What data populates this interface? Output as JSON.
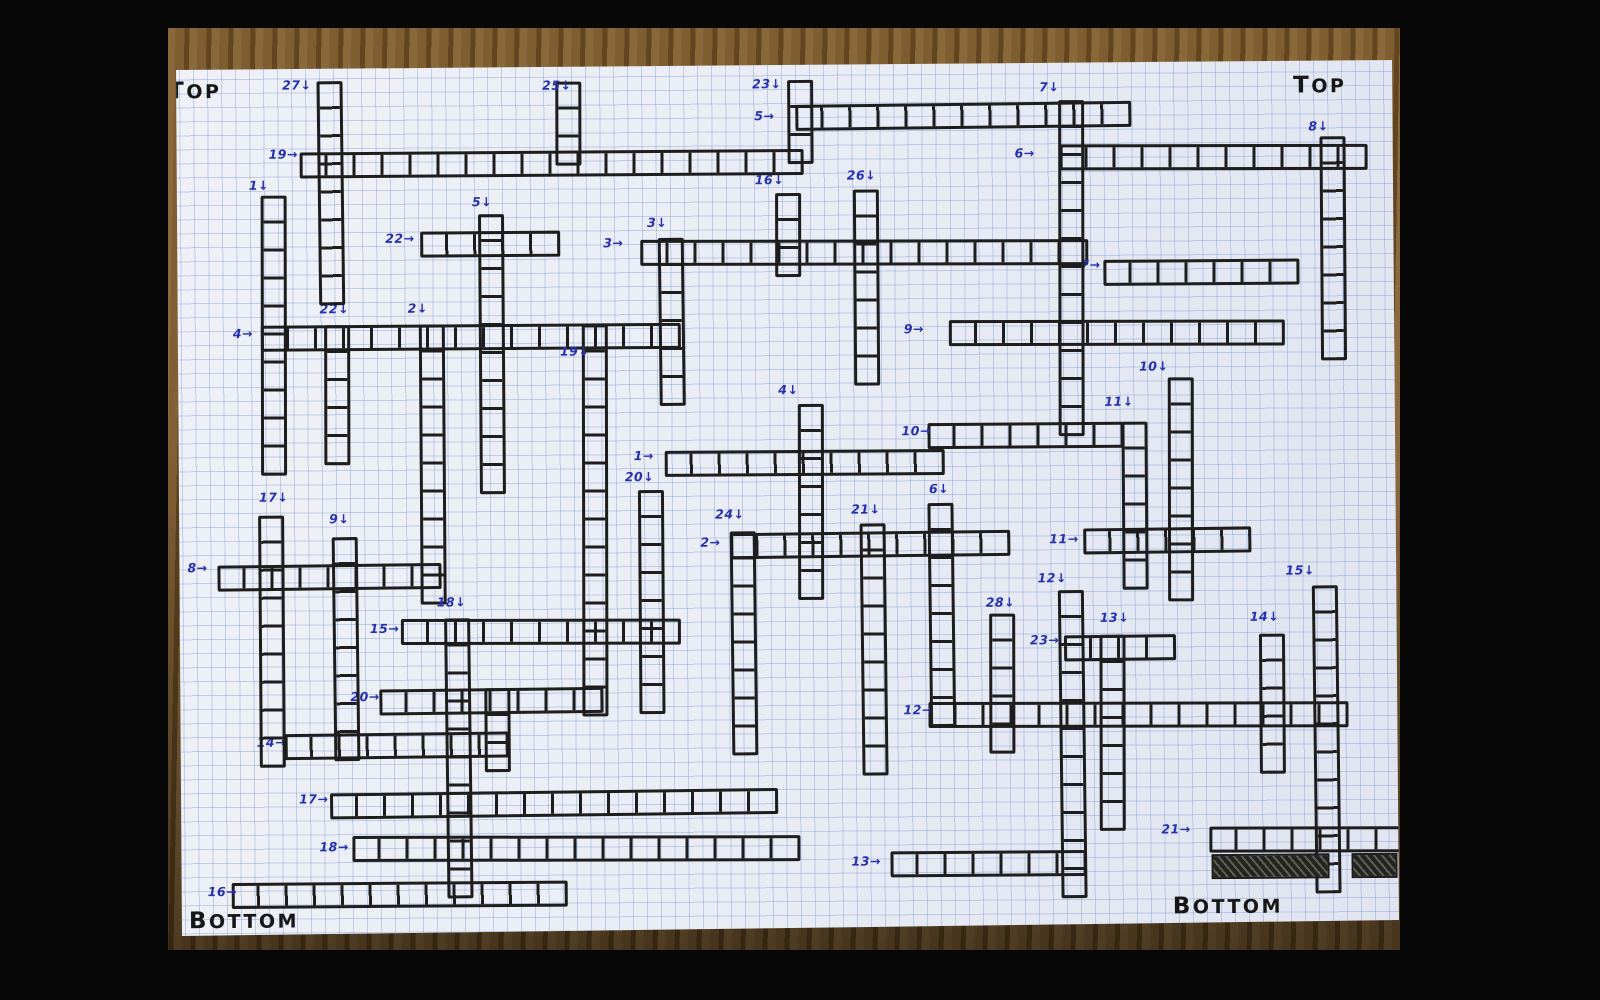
{
  "scene": {
    "colors": {
      "background": "#070707",
      "wood": "#96713f",
      "wood_dark": "#6e5026",
      "paper": "#eaedf5",
      "grid_line": "#7d97cf",
      "ink": "#1d1d1d",
      "pen": "#2531b0"
    }
  },
  "paper": {
    "corner_marks": {
      "top_left": "TOP",
      "top_right": "TOP",
      "bottom_left": "BOTTOM",
      "bottom_right": "BOTTOM"
    }
  },
  "puzzle": {
    "cell_size": 28,
    "across_arrow": "→",
    "down_arrow": "↓",
    "across": [
      {
        "num": "1",
        "x": 665,
        "y": 450,
        "len": 10,
        "lx": 634,
        "ly": 449
      },
      {
        "num": "2",
        "x": 730,
        "y": 532,
        "len": 10,
        "lx": 700,
        "ly": 536
      },
      {
        "num": "3",
        "x": 642,
        "y": 240,
        "len": 16,
        "lx": 605,
        "ly": 236
      },
      {
        "num": "4",
        "x": 262,
        "y": 322,
        "len": 15,
        "lx": 234,
        "ly": 324
      },
      {
        "num": "5",
        "x": 798,
        "y": 104,
        "len": 12,
        "lx": 757,
        "ly": 110
      },
      {
        "num": "6",
        "x": 1062,
        "y": 147,
        "len": 11,
        "lx": 1017,
        "ly": 149
      },
      {
        "num": "7",
        "x": 1105,
        "y": 262,
        "len": 7,
        "lx": 1082,
        "ly": 261
      },
      {
        "num": "8",
        "x": 217,
        "y": 561,
        "len": 8,
        "lx": 187,
        "ly": 558
      },
      {
        "num": "9",
        "x": 950,
        "y": 322,
        "len": 12,
        "lx": 905,
        "ly": 324
      },
      {
        "num": "10",
        "x": 928,
        "y": 424,
        "len": 7,
        "lx": 902,
        "ly": 426
      },
      {
        "num": "11",
        "x": 1083,
        "y": 530,
        "len": 6,
        "lx": 1049,
        "ly": 535
      },
      {
        "num": "12",
        "x": 927,
        "y": 704,
        "len": 15,
        "lx": 902,
        "ly": 705
      },
      {
        "num": "13",
        "x": 888,
        "y": 852,
        "len": 7,
        "lx": 849,
        "ly": 856
      },
      {
        "num": "14",
        "x": 283,
        "y": 730,
        "len": 8,
        "lx": 255,
        "ly": 733
      },
      {
        "num": "15",
        "x": 400,
        "y": 617,
        "len": 10,
        "lx": 369,
        "ly": 620
      },
      {
        "num": "16",
        "x": 229,
        "y": 879,
        "len": 12,
        "lx": 205,
        "ly": 882
      },
      {
        "num": "17",
        "x": 328,
        "y": 789,
        "len": 16,
        "lx": 297,
        "ly": 790
      },
      {
        "num": "18",
        "x": 350,
        "y": 834,
        "len": 16,
        "lx": 317,
        "ly": 838
      },
      {
        "num": "19",
        "x": 302,
        "y": 149,
        "len": 18,
        "lx": 271,
        "ly": 145
      },
      {
        "num": "20",
        "x": 378,
        "y": 686,
        "len": 8,
        "lx": 349,
        "ly": 688
      },
      {
        "num": "21",
        "x": 1207,
        "y": 830,
        "len": 7,
        "lx": 1159,
        "ly": 826
      },
      {
        "num": "22",
        "x": 422,
        "y": 229,
        "len": 5,
        "lx": 387,
        "ly": 230
      },
      {
        "num": "23",
        "x": 1063,
        "y": 637,
        "len": 4,
        "lx": 1029,
        "ly": 636
      }
    ],
    "down": [
      {
        "num": "1",
        "x": 262,
        "y": 192,
        "len": 10,
        "lx": 251,
        "ly": 176
      },
      {
        "num": "2",
        "x": 420,
        "y": 322,
        "len": 10,
        "lx": 409,
        "ly": 300
      },
      {
        "num": "3",
        "x": 660,
        "y": 237,
        "len": 6,
        "lx": 649,
        "ly": 216
      },
      {
        "num": "4",
        "x": 798,
        "y": 404,
        "len": 7,
        "lx": 779,
        "ly": 384
      },
      {
        "num": "5",
        "x": 480,
        "y": 212,
        "len": 10,
        "lx": 474,
        "ly": 194
      },
      {
        "num": "6",
        "x": 928,
        "y": 504,
        "len": 8,
        "lx": 929,
        "ly": 484
      },
      {
        "num": "7",
        "x": 1060,
        "y": 102,
        "len": 12,
        "lx": 1042,
        "ly": 83
      },
      {
        "num": "8",
        "x": 1322,
        "y": 140,
        "len": 8,
        "lx": 1311,
        "ly": 124
      },
      {
        "num": "9",
        "x": 332,
        "y": 534,
        "len": 8,
        "lx": 329,
        "ly": 510
      },
      {
        "num": "10",
        "x": 1168,
        "y": 380,
        "len": 8,
        "lx": 1140,
        "ly": 363
      },
      {
        "num": "11",
        "x": 1122,
        "y": 424,
        "len": 6,
        "lx": 1105,
        "ly": 398
      },
      {
        "num": "12",
        "x": 1058,
        "y": 592,
        "len": 11,
        "lx": 1037,
        "ly": 574
      },
      {
        "num": "13",
        "x": 1098,
        "y": 637,
        "len": 7,
        "lx": 1099,
        "ly": 614
      },
      {
        "num": "14",
        "x": 1258,
        "y": 637,
        "len": 5,
        "lx": 1249,
        "ly": 614
      },
      {
        "num": "15",
        "x": 1312,
        "y": 589,
        "len": 11,
        "lx": 1285,
        "ly": 568
      },
      {
        "num": "16",
        "x": 777,
        "y": 193,
        "len": 3,
        "lx": 757,
        "ly": 174
      },
      {
        "num": "17",
        "x": 258,
        "y": 512,
        "len": 9,
        "lx": 259,
        "ly": 488
      },
      {
        "num": "18",
        "x": 444,
        "y": 616,
        "len": 10,
        "lx": 436,
        "ly": 594
      },
      {
        "num": "19",
        "x": 582,
        "y": 323,
        "len": 14,
        "lx": 561,
        "ly": 344
      },
      {
        "num": "20",
        "x": 638,
        "y": 489,
        "len": 8,
        "lx": 625,
        "ly": 470
      },
      {
        "num": "21",
        "x": 860,
        "y": 524,
        "len": 9,
        "lx": 851,
        "ly": 504
      },
      {
        "num": "22",
        "x": 325,
        "y": 322,
        "len": 5,
        "lx": 321,
        "ly": 300
      },
      {
        "num": "23",
        "x": 790,
        "y": 80,
        "len": 3,
        "lx": 755,
        "ly": 78
      },
      {
        "num": "24",
        "x": 730,
        "y": 531,
        "len": 8,
        "lx": 715,
        "ly": 508
      },
      {
        "num": "25",
        "x": 558,
        "y": 80,
        "len": 3,
        "lx": 545,
        "ly": 78
      },
      {
        "num": "26",
        "x": 855,
        "y": 190,
        "len": 7,
        "lx": 849,
        "ly": 170
      },
      {
        "num": "27",
        "x": 320,
        "y": 78,
        "len": 8,
        "lx": 285,
        "ly": 76
      },
      {
        "num": "28",
        "x": 988,
        "y": 615,
        "len": 5,
        "lx": 985,
        "ly": 598
      }
    ],
    "unnumbered_down": [
      {
        "x": 483,
        "y": 686,
        "len": 3
      }
    ],
    "shaded_cells": [
      {
        "x": 1209,
        "y": 857,
        "w": 118,
        "h": 25
      },
      {
        "x": 1349,
        "y": 857,
        "w": 46,
        "h": 25
      }
    ]
  }
}
